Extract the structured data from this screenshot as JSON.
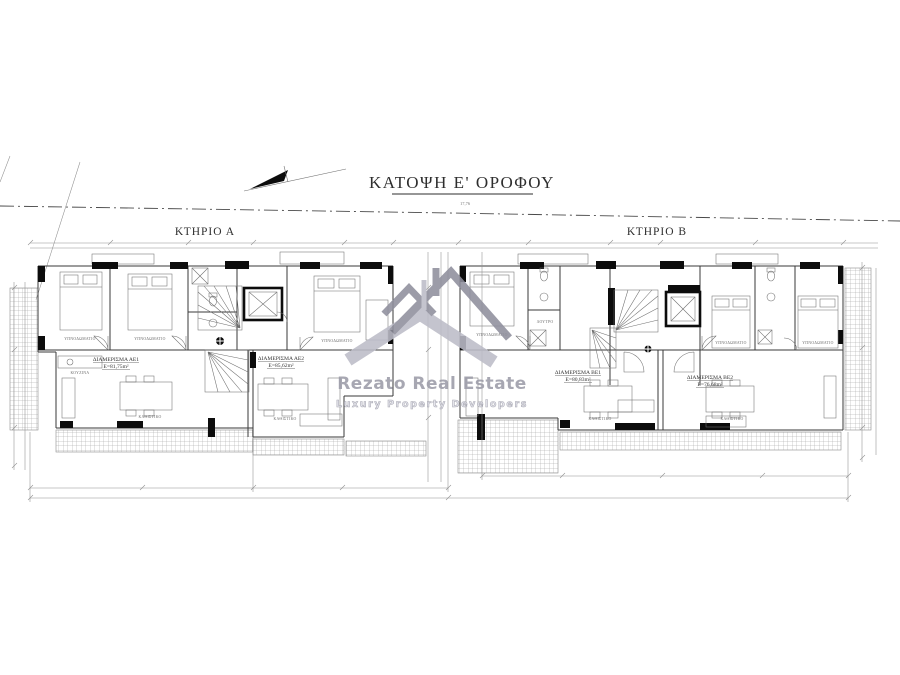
{
  "title": "ΚΑΤΟΨΗ Ε' ΟΡΟΦΟΥ",
  "buildings": {
    "a_label": "ΚΤΗΡΙΟ Α",
    "b_label": "ΚΤΗΡΙΟ Β"
  },
  "apartments": [
    {
      "name": "ΔΙΑΜΕΡΙΣΜΑ ΑΕ1",
      "area": "Ε=81,75m²"
    },
    {
      "name": "ΔΙΑΜΕΡΙΣΜΑ ΑΕ2",
      "area": "Ε=85,62m²"
    },
    {
      "name": "ΔΙΑΜΕΡΙΣΜΑ ΒΕ1",
      "area": "Ε=80,83m²"
    },
    {
      "name": "ΔΙΑΜΕΡΙΣΜΑ ΒΕ2",
      "area": "Ε=76,68m²"
    }
  ],
  "rooms": {
    "bedroom": "ΥΠΝΟΔΩΜΑΤΙΟ",
    "living": "ΚΑΘΙΣΤΙΚΟ",
    "kitchen": "ΚΟΥΖΙΝΑ",
    "bath": "ΛΟΥΤΡΟ"
  },
  "dims": {
    "boundary": "17,76"
  },
  "watermark": {
    "brand": "Rezato Real Estate",
    "tagline": "Luxury  Property  Developers"
  },
  "colors": {
    "line": "#3a3a3a",
    "wall_fill": "#0c0c0c",
    "watermark_dark": "#8f8f9d",
    "watermark_light": "#bcbcc8",
    "background": "#ffffff"
  }
}
